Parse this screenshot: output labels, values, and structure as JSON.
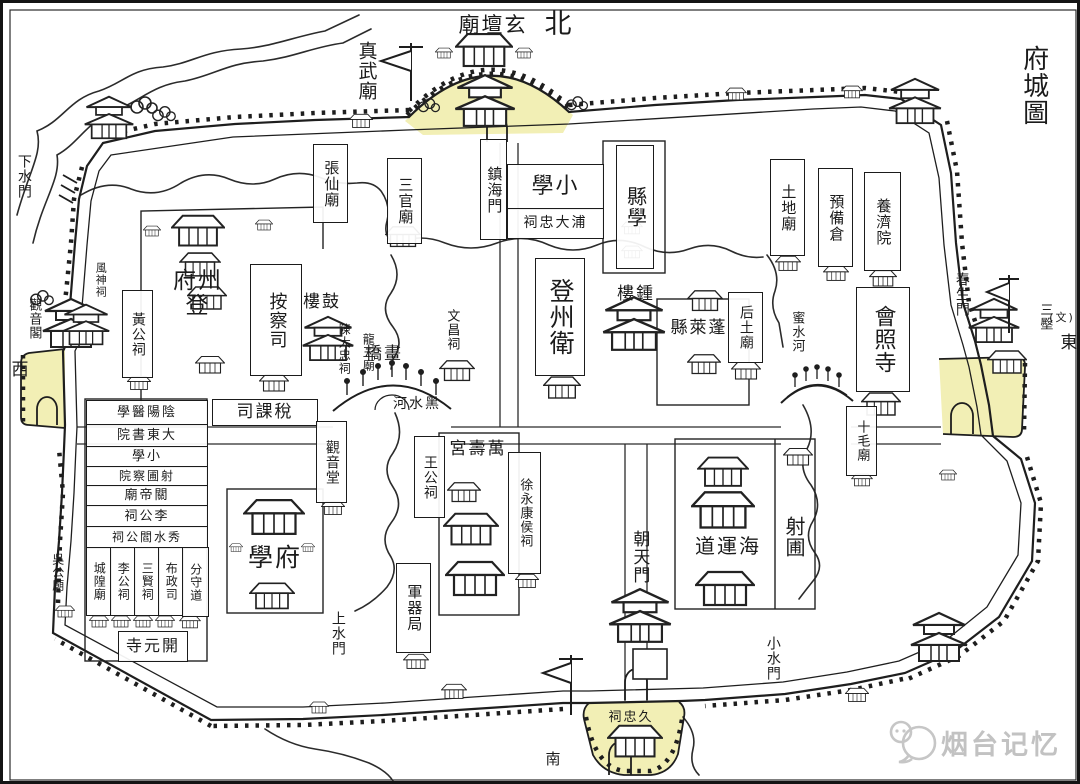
{
  "map": {
    "title": "府城圖",
    "type": "historic-city-map",
    "highlight_color": "#f2efb5",
    "ink_color": "#1b1b1b",
    "watermark": {
      "text": "烟台记忆",
      "color": "#c2c2c2"
    }
  },
  "directions": {
    "north": "北",
    "south": "南",
    "east": "東",
    "west": "西"
  },
  "labels": [
    {
      "id": "map-title",
      "text": "府城圖",
      "x": 1012,
      "y": 30,
      "w": 36,
      "h": 104,
      "o": "v",
      "rtl": false,
      "box": false,
      "fs": 26
    },
    {
      "id": "dir-north",
      "text": "北",
      "x": 538,
      "y": 6,
      "w": 36,
      "h": 32,
      "o": "h",
      "rtl": false,
      "box": false,
      "fs": 27
    },
    {
      "id": "dir-west",
      "text": "西",
      "x": 6,
      "y": 357,
      "w": 24,
      "h": 22,
      "o": "h",
      "rtl": false,
      "box": false,
      "fs": 17
    },
    {
      "id": "dir-east",
      "text": "東",
      "x": 1055,
      "y": 330,
      "w": 24,
      "h": 22,
      "o": "h",
      "rtl": false,
      "box": false,
      "fs": 17
    },
    {
      "id": "dir-south",
      "text": "南",
      "x": 540,
      "y": 747,
      "w": 22,
      "h": 20,
      "o": "h",
      "rtl": false,
      "box": false,
      "fs": 15
    },
    {
      "id": "east-terrace",
      "text": "三壂",
      "x": 1033,
      "y": 291,
      "w": 17,
      "h": 46,
      "o": "v",
      "rtl": false,
      "box": false,
      "fs": 13
    },
    {
      "id": "east-note",
      "text": "(文)",
      "x": 1044,
      "y": 307,
      "w": 30,
      "h": 16,
      "o": "h",
      "rtl": false,
      "box": false,
      "fs": 11
    },
    {
      "id": "zhenwu-temple",
      "text": "真武廟",
      "x": 350,
      "y": 25,
      "w": 25,
      "h": 86,
      "o": "v",
      "rtl": false,
      "box": false,
      "fs": 19
    },
    {
      "id": "xuantan-temple",
      "text": "玄壇廟",
      "x": 449,
      "y": 9,
      "w": 82,
      "h": 27,
      "o": "h",
      "rtl": true,
      "box": false,
      "fs": 21
    },
    {
      "id": "zhangxian-temple",
      "text": "張仙廟",
      "x": 310,
      "y": 141,
      "w": 33,
      "h": 77,
      "o": "v",
      "rtl": false,
      "box": true,
      "fs": 15
    },
    {
      "id": "sanguan-temple",
      "text": "三官廟",
      "x": 384,
      "y": 155,
      "w": 33,
      "h": 84,
      "o": "v",
      "rtl": false,
      "box": true,
      "fs": 15
    },
    {
      "id": "zhenhai-gate",
      "text": "鎮海門",
      "x": 477,
      "y": 136,
      "w": 25,
      "h": 99,
      "o": "v",
      "rtl": false,
      "box": true,
      "fs": 15
    },
    {
      "id": "xiaoxue-school",
      "text": "小學",
      "x": 504,
      "y": 161,
      "w": 95,
      "h": 44,
      "o": "h",
      "rtl": true,
      "box": true,
      "fs": 22
    },
    {
      "id": "pudazhong-shrine",
      "text": "浦大忠祠",
      "x": 504,
      "y": 205,
      "w": 95,
      "h": 29,
      "o": "h",
      "rtl": true,
      "box": true,
      "fs": 14
    },
    {
      "id": "xianxue-school",
      "text": "縣學",
      "x": 613,
      "y": 142,
      "w": 36,
      "h": 122,
      "o": "v",
      "rtl": false,
      "box": true,
      "fs": 20
    },
    {
      "id": "tudi-temple",
      "text": "土地廟",
      "x": 767,
      "y": 156,
      "w": 33,
      "h": 95,
      "o": "v",
      "rtl": false,
      "box": true,
      "fs": 15
    },
    {
      "id": "yubei-granary",
      "text": "預備倉",
      "x": 815,
      "y": 165,
      "w": 33,
      "h": 97,
      "o": "v",
      "rtl": false,
      "box": true,
      "fs": 15
    },
    {
      "id": "yangji-house",
      "text": "養濟院",
      "x": 861,
      "y": 169,
      "w": 35,
      "h": 97,
      "o": "v",
      "rtl": false,
      "box": true,
      "fs": 15
    },
    {
      "id": "xiashui-gate",
      "text": "下水門",
      "x": 9,
      "y": 142,
      "w": 23,
      "h": 62,
      "o": "v",
      "rtl": false,
      "box": false,
      "fs": 14
    },
    {
      "id": "guanyin-pavilion",
      "text": "觀音閣",
      "x": 21,
      "y": 285,
      "w": 19,
      "h": 62,
      "o": "v",
      "rtl": false,
      "box": false,
      "fs": 13
    },
    {
      "id": "fengshen-shrine",
      "text": "風神祠",
      "x": 88,
      "y": 251,
      "w": 19,
      "h": 52,
      "o": "v",
      "rtl": false,
      "box": false,
      "fs": 11
    },
    {
      "id": "huanggong-shrine",
      "text": "黃公祠",
      "x": 119,
      "y": 287,
      "w": 29,
      "h": 86,
      "o": "v",
      "rtl": false,
      "box": true,
      "fs": 14
    },
    {
      "id": "dengzhou-fu",
      "text": "登州府",
      "x": 160,
      "y": 273,
      "w": 70,
      "h": 35,
      "o": "h",
      "rtl": true,
      "box": false,
      "fs": 23
    },
    {
      "id": "ancha-si",
      "text": "按察司",
      "x": 247,
      "y": 261,
      "w": 50,
      "h": 110,
      "o": "v",
      "rtl": false,
      "box": true,
      "fs": 18
    },
    {
      "id": "gu-lou",
      "text": "鼓樓",
      "x": 294,
      "y": 287,
      "w": 50,
      "h": 25,
      "o": "h",
      "rtl": true,
      "box": false,
      "fs": 17
    },
    {
      "id": "chendazhong-shrine",
      "text": "陳大忠祠",
      "x": 329,
      "y": 313,
      "w": 24,
      "h": 66,
      "o": "v",
      "rtl": false,
      "box": false,
      "fs": 12
    },
    {
      "id": "longwang-temple",
      "text": "龍王廟",
      "x": 354,
      "y": 321,
      "w": 22,
      "h": 57,
      "o": "v",
      "rtl": false,
      "box": false,
      "fs": 12
    },
    {
      "id": "wenchang-shrine",
      "text": "文昌祠",
      "x": 437,
      "y": 297,
      "w": 23,
      "h": 60,
      "o": "v",
      "rtl": false,
      "box": false,
      "fs": 13
    },
    {
      "id": "hua-qiao",
      "text": "畫橋",
      "x": 341,
      "y": 339,
      "w": 80,
      "h": 25,
      "o": "h",
      "rtl": true,
      "box": false,
      "fs": 17
    },
    {
      "id": "heishui-river",
      "text": "黑水河",
      "x": 380,
      "y": 391,
      "w": 68,
      "h": 20,
      "o": "h",
      "rtl": true,
      "box": false,
      "fs": 14
    },
    {
      "id": "dengzhou-wei",
      "text": "登州衛",
      "x": 532,
      "y": 255,
      "w": 48,
      "h": 116,
      "o": "v",
      "rtl": false,
      "box": true,
      "fs": 25
    },
    {
      "id": "zhong-lou",
      "text": "鍾樓",
      "x": 607,
      "y": 279,
      "w": 52,
      "h": 25,
      "o": "h",
      "rtl": true,
      "box": false,
      "fs": 17
    },
    {
      "id": "penglai-xian",
      "text": "蓬萊縣",
      "x": 660,
      "y": 312,
      "w": 72,
      "h": 28,
      "o": "h",
      "rtl": true,
      "box": false,
      "fs": 17
    },
    {
      "id": "houtu-temple",
      "text": "后土廟",
      "x": 725,
      "y": 289,
      "w": 33,
      "h": 69,
      "o": "v",
      "rtl": false,
      "box": true,
      "fs": 14
    },
    {
      "id": "mishui-river",
      "text": "蜜水河",
      "x": 783,
      "y": 297,
      "w": 21,
      "h": 64,
      "o": "v",
      "rtl": false,
      "box": false,
      "fs": 13
    },
    {
      "id": "huizhao-temple",
      "text": "會照寺",
      "x": 853,
      "y": 284,
      "w": 52,
      "h": 103,
      "o": "v",
      "rtl": false,
      "box": true,
      "fs": 22
    },
    {
      "id": "chunsheng-gate",
      "text": "春生門",
      "x": 947,
      "y": 259,
      "w": 23,
      "h": 64,
      "o": "v",
      "rtl": false,
      "box": false,
      "fs": 14
    },
    {
      "id": "shimao-temple",
      "text": "十毛廟",
      "x": 843,
      "y": 403,
      "w": 29,
      "h": 68,
      "o": "v",
      "rtl": false,
      "box": true,
      "fs": 13
    },
    {
      "id": "shuike-si",
      "text": "稅課司",
      "x": 209,
      "y": 396,
      "w": 104,
      "h": 25,
      "o": "h",
      "rtl": true,
      "box": true,
      "fs": 17
    },
    {
      "id": "guanyin-hall",
      "text": "觀音堂",
      "x": 313,
      "y": 418,
      "w": 29,
      "h": 80,
      "o": "v",
      "rtl": false,
      "box": true,
      "fs": 14
    },
    {
      "id": "yinyang-yixue",
      "text": "陰陽醫學",
      "x": 83,
      "y": 397,
      "w": 120,
      "h": 24,
      "o": "h",
      "rtl": true,
      "box": true,
      "fs": 13
    },
    {
      "id": "dadong-academy",
      "text": "大東書院",
      "x": 83,
      "y": 421,
      "w": 120,
      "h": 22,
      "o": "h",
      "rtl": true,
      "box": true,
      "fs": 13
    },
    {
      "id": "xiaoxue-row",
      "text": "小學",
      "x": 83,
      "y": 443,
      "w": 120,
      "h": 20,
      "o": "h",
      "rtl": true,
      "box": true,
      "fs": 13
    },
    {
      "id": "shepu-chayuan",
      "text": "射圃察院",
      "x": 83,
      "y": 463,
      "w": 120,
      "h": 19,
      "o": "h",
      "rtl": true,
      "box": true,
      "fs": 12
    },
    {
      "id": "guandi-temple",
      "text": "關帝廟",
      "x": 83,
      "y": 482,
      "w": 120,
      "h": 20,
      "o": "h",
      "rtl": true,
      "box": true,
      "fs": 13
    },
    {
      "id": "ligong-shrine-row",
      "text": "李公祠",
      "x": 83,
      "y": 502,
      "w": 120,
      "h": 21,
      "o": "h",
      "rtl": true,
      "box": true,
      "fs": 13
    },
    {
      "id": "xiushui-yangong-shrine",
      "text": "秀水閻公祠",
      "x": 83,
      "y": 523,
      "w": 120,
      "h": 21,
      "o": "h",
      "rtl": true,
      "box": true,
      "fs": 12
    },
    {
      "id": "chenghuang-temple",
      "text": "城隍廟",
      "x": 83,
      "y": 544,
      "w": 24,
      "h": 67,
      "o": "v",
      "rtl": false,
      "box": true,
      "fs": 12
    },
    {
      "id": "ligong-shrine",
      "text": "李公祠",
      "x": 107,
      "y": 544,
      "w": 24,
      "h": 67,
      "o": "v",
      "rtl": false,
      "box": true,
      "fs": 12
    },
    {
      "id": "sanxian-shrine",
      "text": "三賢祠",
      "x": 131,
      "y": 544,
      "w": 24,
      "h": 67,
      "o": "v",
      "rtl": false,
      "box": true,
      "fs": 12
    },
    {
      "id": "buzheng-si",
      "text": "布政司",
      "x": 155,
      "y": 544,
      "w": 24,
      "h": 67,
      "o": "v",
      "rtl": false,
      "box": true,
      "fs": 12
    },
    {
      "id": "fenshou-dao",
      "text": "分守道",
      "x": 179,
      "y": 544,
      "w": 25,
      "h": 68,
      "o": "v",
      "rtl": false,
      "box": true,
      "fs": 12
    },
    {
      "id": "kaiyuan-temple",
      "text": "開元寺",
      "x": 115,
      "y": 628,
      "w": 68,
      "h": 29,
      "o": "h",
      "rtl": true,
      "box": true,
      "fs": 16
    },
    {
      "id": "wugong-temple",
      "text": "吳公廟",
      "x": 45,
      "y": 539,
      "w": 19,
      "h": 60,
      "o": "v",
      "rtl": false,
      "box": false,
      "fs": 12
    },
    {
      "id": "fu-xue",
      "text": "府學",
      "x": 234,
      "y": 537,
      "w": 76,
      "h": 37,
      "o": "h",
      "rtl": true,
      "box": false,
      "fs": 25
    },
    {
      "id": "shangshui-gate",
      "text": "上水門",
      "x": 323,
      "y": 601,
      "w": 23,
      "h": 58,
      "o": "v",
      "rtl": false,
      "box": false,
      "fs": 14
    },
    {
      "id": "wanggong-shrine",
      "text": "王公祠",
      "x": 411,
      "y": 433,
      "w": 29,
      "h": 80,
      "o": "v",
      "rtl": false,
      "box": true,
      "fs": 14
    },
    {
      "id": "wanshou-palace",
      "text": "萬壽宮",
      "x": 437,
      "y": 433,
      "w": 76,
      "h": 27,
      "o": "h",
      "rtl": true,
      "box": false,
      "fs": 17
    },
    {
      "id": "xuyongkang-shrine",
      "text": "徐永康侯祠",
      "x": 505,
      "y": 449,
      "w": 31,
      "h": 120,
      "o": "v",
      "rtl": false,
      "box": true,
      "fs": 13
    },
    {
      "id": "junqi-bureau",
      "text": "軍器局",
      "x": 393,
      "y": 560,
      "w": 33,
      "h": 88,
      "o": "v",
      "rtl": false,
      "box": true,
      "fs": 15
    },
    {
      "id": "chaotian-gate",
      "text": "朝天門",
      "x": 623,
      "y": 513,
      "w": 25,
      "h": 82,
      "o": "v",
      "rtl": false,
      "box": false,
      "fs": 17
    },
    {
      "id": "jiuzhong-shrine",
      "text": "久忠祠",
      "x": 596,
      "y": 705,
      "w": 64,
      "h": 20,
      "o": "h",
      "rtl": true,
      "box": false,
      "fs": 13
    },
    {
      "id": "haiyun-dao",
      "text": "海運道",
      "x": 673,
      "y": 528,
      "w": 104,
      "h": 31,
      "o": "h",
      "rtl": true,
      "box": false,
      "fs": 20
    },
    {
      "id": "she-pu",
      "text": "射圃",
      "x": 777,
      "y": 477,
      "w": 27,
      "h": 114,
      "o": "v",
      "rtl": false,
      "box": false,
      "fs": 20
    },
    {
      "id": "xiaoshui-gate",
      "text": "小水門",
      "x": 757,
      "y": 625,
      "w": 25,
      "h": 60,
      "o": "v",
      "rtl": false,
      "box": false,
      "fs": 14
    }
  ]
}
